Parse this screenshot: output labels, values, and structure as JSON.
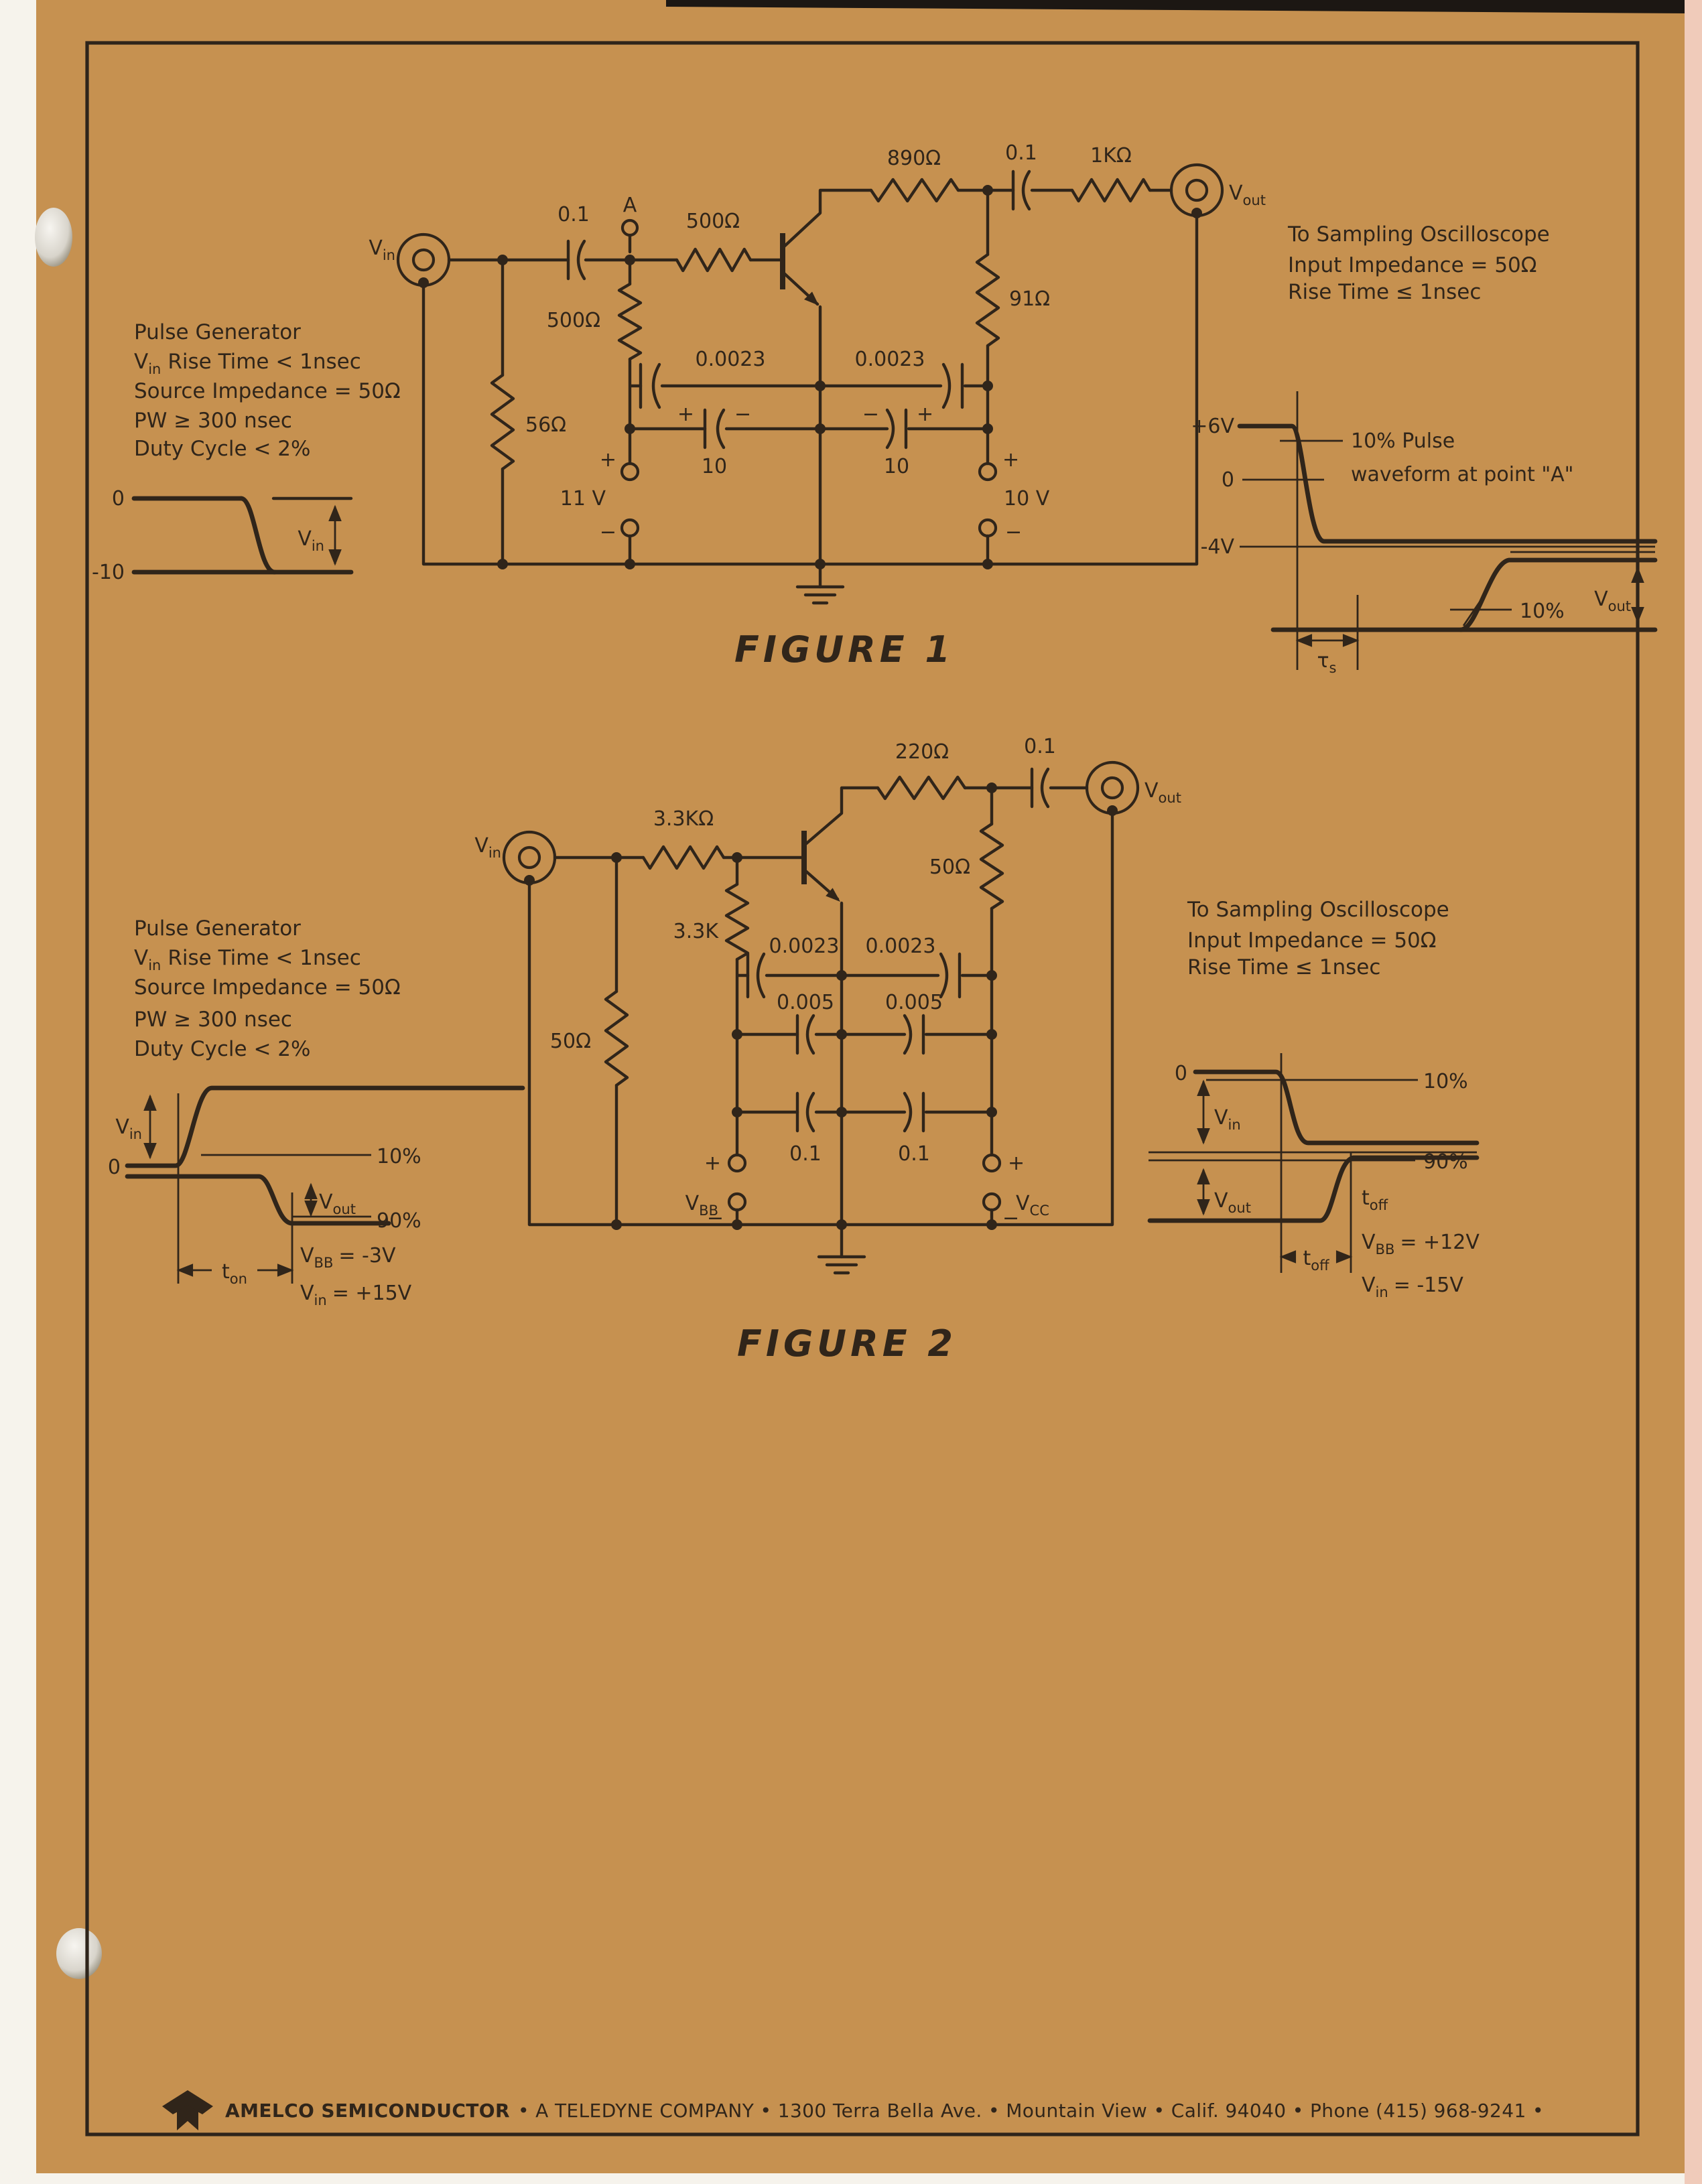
{
  "page": {
    "colors": {
      "paper": "#c69150",
      "ink": "#30251a",
      "border": "#2e241a",
      "top_band": "#1c1713",
      "edge_strip": "#f6f3ec",
      "right_strip": "#f0cbba"
    },
    "footer": {
      "brand": "AMELCO SEMICONDUCTOR",
      "rest": "• A TELEDYNE COMPANY • 1300 Terra Bella Ave. • Mountain View • Calif. 94040 • Phone (415) 968-9241 •"
    }
  },
  "sym": {
    "v": "V",
    "sub_in": "in",
    "sub_out": "out",
    "sub_bb": "BB",
    "sub_cc": "CC",
    "t": "t",
    "sub_on": "on",
    "sub_off": "off",
    "tau": "τ",
    "sub_s": "s",
    "plus": "+",
    "minus": "−"
  },
  "fig1": {
    "caption": "FIGURE 1",
    "generator_notes": {
      "title": "Pulse Generator",
      "rise_time_rest": "Rise Time < 1nsec",
      "source_impedance": "Source Impedance = 50Ω",
      "pulse_width": "PW ≥ 300 nsec",
      "duty_cycle": "Duty Cycle < 2%"
    },
    "scope_notes": [
      "To Sampling Oscilloscope",
      "Input Impedance = 50Ω",
      "Rise Time ≤ 1nsec"
    ],
    "components": {
      "input_cap": "0.1",
      "point_label": "A",
      "base_series_resistor": "500Ω",
      "shunt_resistor_a": "500Ω",
      "input_shunt_resistor": "56Ω",
      "collector_resistor": "890Ω",
      "output_cap": "0.1",
      "output_series_resistor": "1KΩ",
      "output_shunt_resistor": "91Ω",
      "feedback_cap_left": "0.0023",
      "feedback_cap_right": "0.0023",
      "bypass_cap_left": "10",
      "bypass_cap_right": "10",
      "left_supply": "11 V",
      "right_supply": "10 V"
    },
    "input_waveform": {
      "top_level": "0",
      "bottom_level": "-10"
    },
    "output_waveform": {
      "plus6": "+6V",
      "zero": "0",
      "minus4": "-4V",
      "note_line1": "10% Pulse",
      "note_line2": "waveform at point \"A\"",
      "ten_pct": "10%"
    }
  },
  "fig2": {
    "caption": "FIGURE 2",
    "generator_notes": {
      "title": "Pulse Generator",
      "rise_time_rest": "Rise Time < 1nsec",
      "source_impedance": "Source Impedance = 50Ω",
      "pulse_width": "PW ≥ 300 nsec",
      "duty_cycle": "Duty Cycle < 2%"
    },
    "scope_notes": [
      "To Sampling Oscilloscope",
      "Input Impedance = 50Ω",
      "Rise Time ≤ 1nsec"
    ],
    "components": {
      "base_series_resistor": "3.3KΩ",
      "base_shunt_resistor": "3.3K",
      "input_shunt_resistor": "50Ω",
      "collector_resistor": "220Ω",
      "load_resistor": "50Ω",
      "output_cap": "0.1",
      "feedback_cap_left": "0.0023",
      "feedback_cap_right": "0.0023",
      "mid_cap_left": "0.005",
      "mid_cap_right": "0.005",
      "low_cap_left": "0.1",
      "low_cap_right": "0.1"
    },
    "left_waveform": {
      "zero": "0",
      "ten_pct": "10%",
      "ninety_pct": "90%",
      "vbb_eq": "= -3V",
      "vin_eq": "= +15V"
    },
    "right_waveform": {
      "zero": "0",
      "ten_pct": "10%",
      "ninety_pct": "90%",
      "vbb_eq": "= +12V",
      "vin_eq": "= -15V"
    }
  }
}
